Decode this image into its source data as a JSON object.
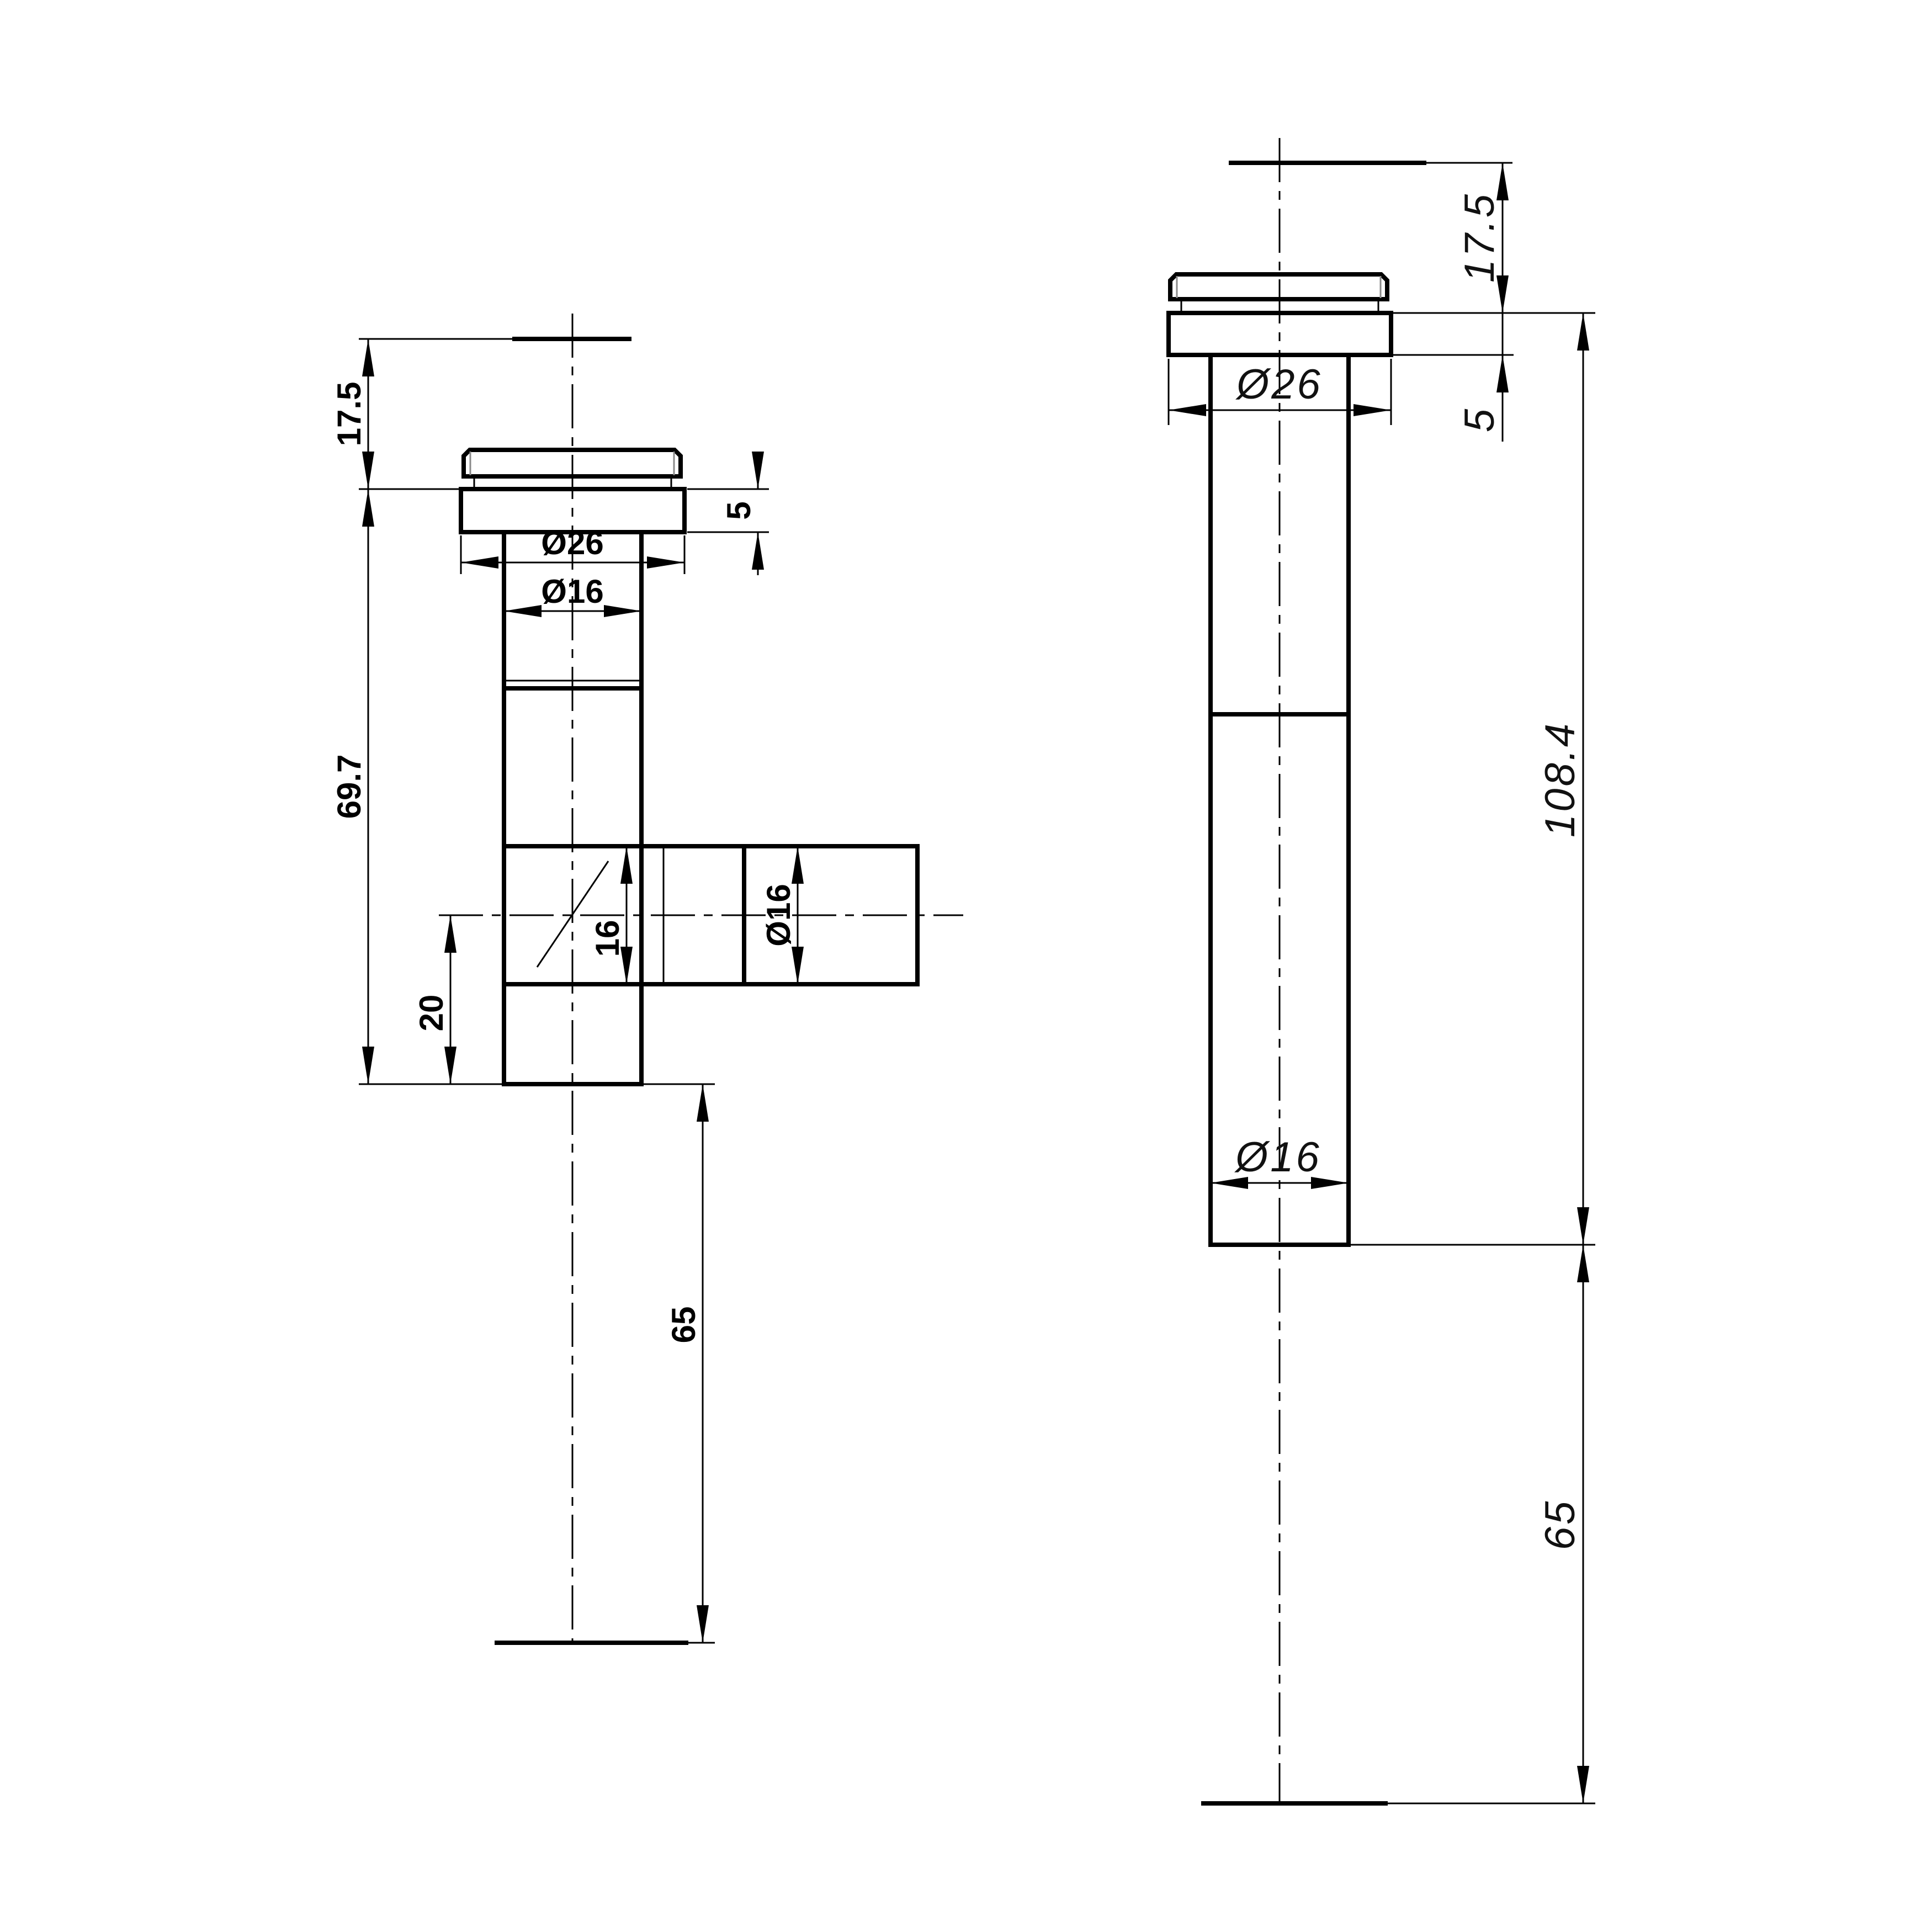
{
  "drawing": {
    "type": "engineering-orthographic-views",
    "background_color": "#ffffff",
    "line_color": "#000000",
    "units": "mm",
    "left_view": {
      "description": "Tee drain fitting with side branch outlet, cap and collar at top",
      "labels": {
        "height_17_5": "17.5",
        "collar_5": "5",
        "dia_26": "Ø26",
        "dia_16_top": "Ø16",
        "length_69_7": "69.7",
        "branch_offset_20": "20",
        "bore_16": "16",
        "branch_dia_16": "Ø16",
        "tail_65": "65"
      }
    },
    "right_view": {
      "description": "Straight drain fitting with cap and collar at top",
      "labels": {
        "height_17_5": "17.5",
        "collar_5": "5",
        "dia_26": "Ø26",
        "length_108_4": "108.4",
        "dia_16": "Ø16",
        "tail_65": "65"
      }
    },
    "dimensions_mm": {
      "left_view": [
        17.5,
        5,
        26,
        16,
        69.7,
        20,
        16,
        16,
        65
      ],
      "right_view": [
        17.5,
        5,
        26,
        108.4,
        16,
        65
      ]
    }
  }
}
